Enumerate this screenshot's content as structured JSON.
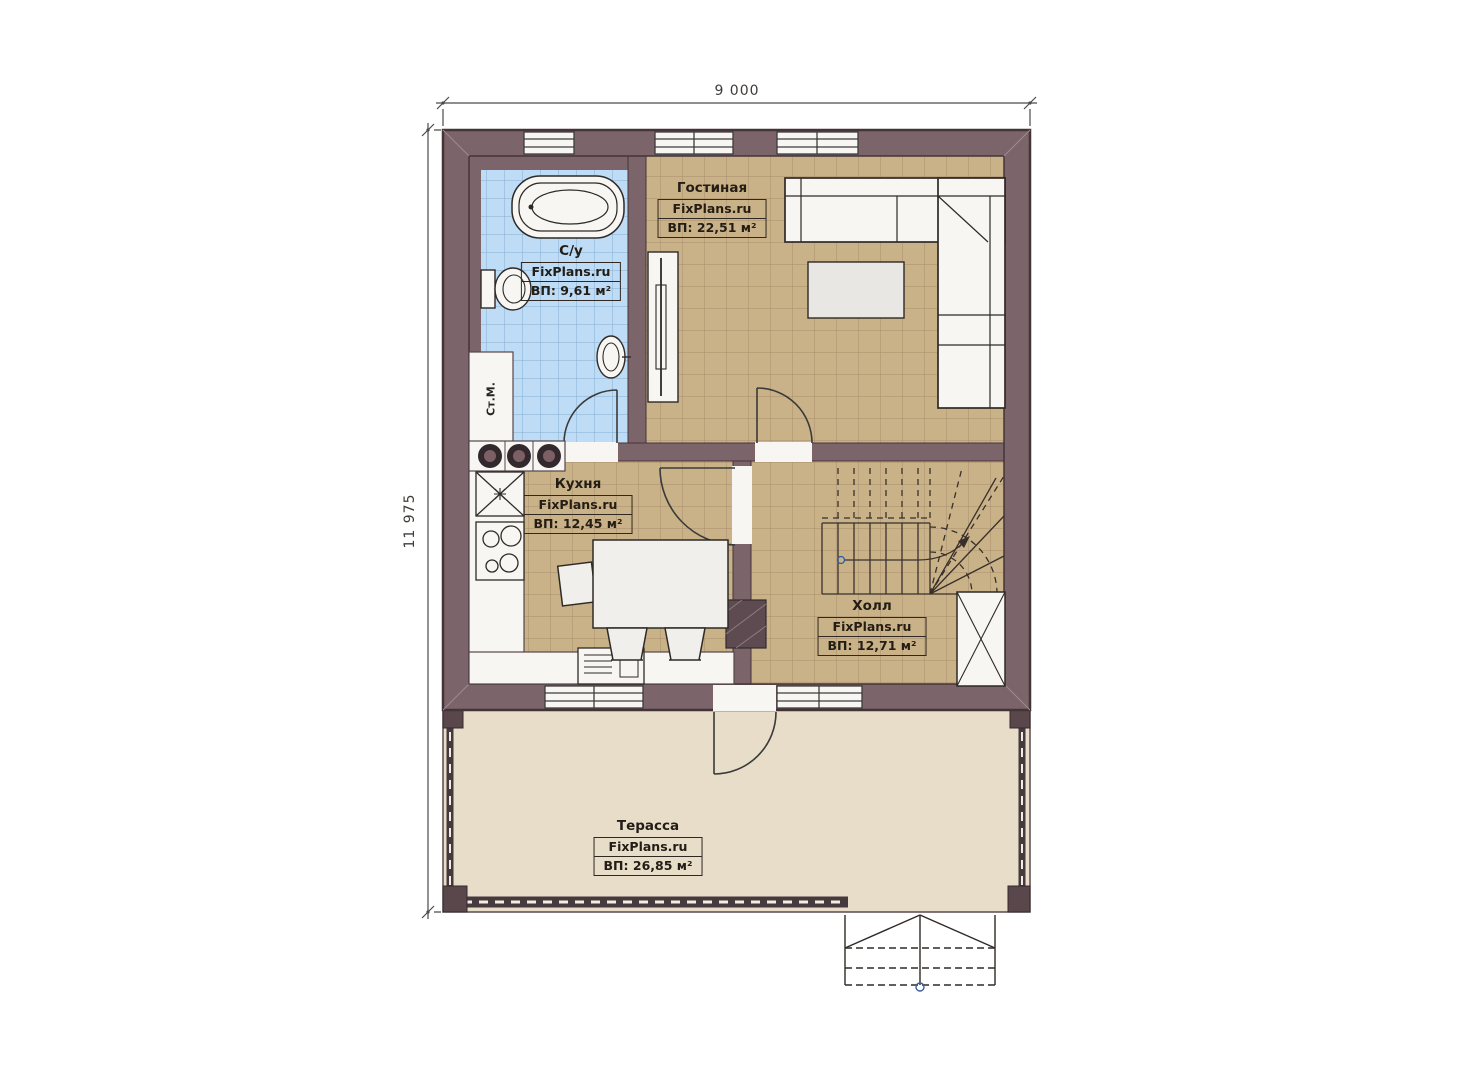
{
  "dimensions": {
    "width": "9 000",
    "height": "11 975"
  },
  "brand": "FixPlans.ru",
  "rooms": [
    {
      "key": "bathroom",
      "name": "С/у",
      "brand": "FixPlans.ru",
      "area": "ВП: 9,61 м²"
    },
    {
      "key": "living-room",
      "name": "Гостиная",
      "brand": "FixPlans.ru",
      "area": "ВП: 22,51 м²"
    },
    {
      "key": "kitchen",
      "name": "Кухня",
      "brand": "FixPlans.ru",
      "area": "ВП: 12,45 м²"
    },
    {
      "key": "hall",
      "name": "Холл",
      "brand": "FixPlans.ru",
      "area": "ВП: 12,71 м²"
    },
    {
      "key": "terrace",
      "name": "Терасса",
      "brand": "FixPlans.ru",
      "area": "ВП: 26,85 м²"
    }
  ],
  "fixtures": {
    "washing_machine": "Ст.М."
  },
  "colors": {
    "wall": "#7b656a",
    "wall_outline": "#443438",
    "floor_tan": "#c9b287",
    "floor_tan_grid": "#a98f6e",
    "floor_blue": "#bedcf5",
    "floor_blue_grid": "#85aed4",
    "terrace_floor": "#e7ddc9",
    "fixture_white": "#f7f6f3",
    "ink": "#262019"
  }
}
